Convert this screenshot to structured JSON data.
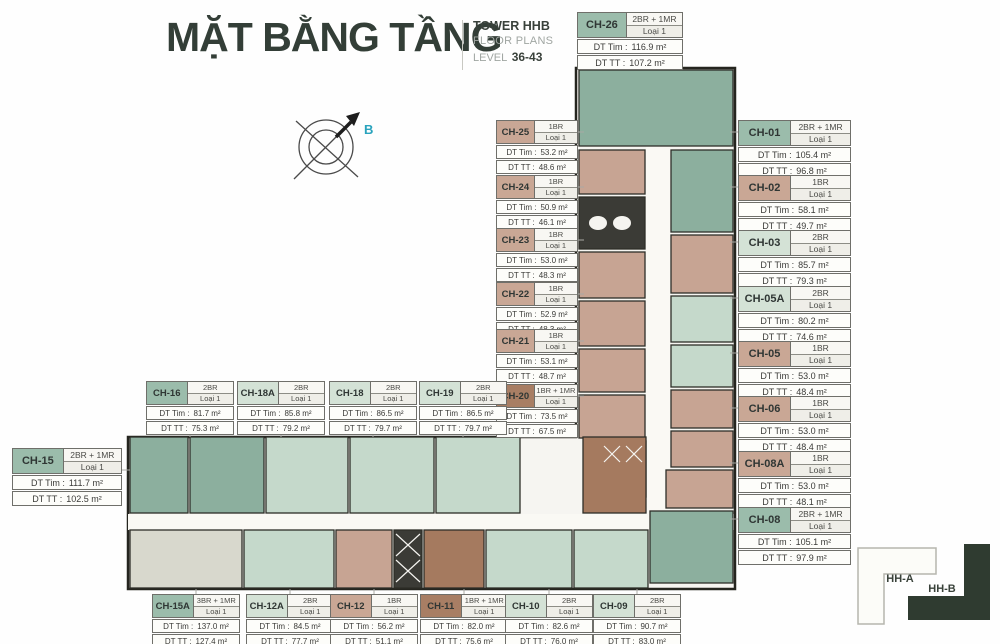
{
  "header": {
    "title": "MẶT BẰNG TẦNG",
    "tower": "TOWER HHB",
    "subtitle": "FLOOR PLANS",
    "level_label": "LEVEL",
    "level_value": "36-43"
  },
  "compass": {
    "label": "B"
  },
  "labels": {
    "dt_tim": "DT Tim :",
    "dt_tt": "DT TT :"
  },
  "colors": {
    "green": "#9bbcab",
    "ltgreen": "#d4e2d6",
    "tan": "#c9a795",
    "brown": "#a87e64"
  },
  "keyplan": {
    "building_a": "HH-A",
    "building_b": "HH-B"
  },
  "units": [
    {
      "id": "CH-26",
      "type": "2BR + 1MR",
      "loai": "Loại 1",
      "dt_tim": "116.9 m²",
      "dt_tt": "107.2 m²",
      "color": "green",
      "x": 577,
      "y": 12,
      "w": 106,
      "size": "md"
    },
    {
      "id": "CH-01",
      "type": "2BR + 1MR",
      "loai": "Loại 1",
      "dt_tim": "105.4 m²",
      "dt_tt": "96.8 m²",
      "color": "green",
      "x": 738,
      "y": 120,
      "w": 113,
      "size": "md"
    },
    {
      "id": "CH-02",
      "type": "1BR",
      "loai": "Loại 1",
      "dt_tim": "58.1 m²",
      "dt_tt": "49.7 m²",
      "color": "tan",
      "x": 738,
      "y": 175,
      "w": 113,
      "size": "md"
    },
    {
      "id": "CH-03",
      "type": "2BR",
      "loai": "Loại 1",
      "dt_tim": "85.7 m²",
      "dt_tt": "79.3 m²",
      "color": "ltgreen",
      "x": 738,
      "y": 230,
      "w": 113,
      "size": "md"
    },
    {
      "id": "CH-05A",
      "type": "2BR",
      "loai": "Loại 1",
      "dt_tim": "80.2 m²",
      "dt_tt": "74.6 m²",
      "color": "ltgreen",
      "x": 738,
      "y": 286,
      "w": 113,
      "size": "md"
    },
    {
      "id": "CH-05",
      "type": "1BR",
      "loai": "Loại 1",
      "dt_tim": "53.0 m²",
      "dt_tt": "48.4 m²",
      "color": "tan",
      "x": 738,
      "y": 341,
      "w": 113,
      "size": "md"
    },
    {
      "id": "CH-06",
      "type": "1BR",
      "loai": "Loại 1",
      "dt_tim": "53.0 m²",
      "dt_tt": "48.4 m²",
      "color": "tan",
      "x": 738,
      "y": 396,
      "w": 113,
      "size": "md"
    },
    {
      "id": "CH-08A",
      "type": "1BR",
      "loai": "Loại 1",
      "dt_tim": "53.0 m²",
      "dt_tt": "48.1 m²",
      "color": "tan",
      "x": 738,
      "y": 451,
      "w": 113,
      "size": "md"
    },
    {
      "id": "CH-08",
      "type": "2BR + 1MR",
      "loai": "Loại 1",
      "dt_tim": "105.1 m²",
      "dt_tt": "97.9 m²",
      "color": "green",
      "x": 738,
      "y": 507,
      "w": 113,
      "size": "md"
    },
    {
      "id": "CH-25",
      "type": "1BR",
      "loai": "Loại 1",
      "dt_tim": "53.2 m²",
      "dt_tt": "48.6 m²",
      "color": "tan",
      "x": 496,
      "y": 120,
      "w": 82,
      "size": "sm"
    },
    {
      "id": "CH-24",
      "type": "1BR",
      "loai": "Loại 1",
      "dt_tim": "50.9 m²",
      "dt_tt": "46.1 m²",
      "color": "tan",
      "x": 496,
      "y": 175,
      "w": 82,
      "size": "sm"
    },
    {
      "id": "CH-23",
      "type": "1BR",
      "loai": "Loại 1",
      "dt_tim": "53.0 m²",
      "dt_tt": "48.3 m²",
      "color": "tan",
      "x": 496,
      "y": 228,
      "w": 82,
      "size": "sm"
    },
    {
      "id": "CH-22",
      "type": "1BR",
      "loai": "Loại 1",
      "dt_tim": "52.9 m²",
      "dt_tt": "48.3 m²",
      "color": "tan",
      "x": 496,
      "y": 282,
      "w": 82,
      "size": "sm"
    },
    {
      "id": "CH-21",
      "type": "1BR",
      "loai": "Loại 1",
      "dt_tim": "53.1 m²",
      "dt_tt": "48.7 m²",
      "color": "tan",
      "x": 496,
      "y": 329,
      "w": 82,
      "size": "sm"
    },
    {
      "id": "CH-20",
      "type": "1BR + 1MR",
      "loai": "Loại 1",
      "dt_tim": "73.5 m²",
      "dt_tt": "67.5 m²",
      "color": "brown",
      "x": 496,
      "y": 384,
      "w": 82,
      "size": "sm"
    },
    {
      "id": "CH-16",
      "type": "2BR",
      "loai": "Loại 1",
      "dt_tim": "81.7 m²",
      "dt_tt": "75.3 m²",
      "color": "green",
      "x": 146,
      "y": 381,
      "w": 88,
      "size": "sm"
    },
    {
      "id": "CH-18A",
      "type": "2BR",
      "loai": "Loại 1",
      "dt_tim": "85.8 m²",
      "dt_tt": "79.2 m²",
      "color": "ltgreen",
      "x": 237,
      "y": 381,
      "w": 88,
      "size": "sm"
    },
    {
      "id": "CH-18",
      "type": "2BR",
      "loai": "Loại 1",
      "dt_tim": "86.5 m²",
      "dt_tt": "79.7 m²",
      "color": "ltgreen",
      "x": 329,
      "y": 381,
      "w": 88,
      "size": "sm"
    },
    {
      "id": "CH-19",
      "type": "2BR",
      "loai": "Loại 1",
      "dt_tim": "86.5 m²",
      "dt_tt": "79.7 m²",
      "color": "ltgreen",
      "x": 419,
      "y": 381,
      "w": 88,
      "size": "sm"
    },
    {
      "id": "CH-15",
      "type": "2BR + 1MR",
      "loai": "Loại 1",
      "dt_tim": "111.7 m²",
      "dt_tt": "102.5 m²",
      "color": "green",
      "x": 12,
      "y": 448,
      "w": 110,
      "size": "md"
    },
    {
      "id": "CH-15A",
      "type": "3BR + 1MR",
      "loai": "Loại 1",
      "dt_tim": "137.0 m²",
      "dt_tt": "127.4 m²",
      "color": "green",
      "x": 152,
      "y": 594,
      "w": 88,
      "size": "sm"
    },
    {
      "id": "CH-12A",
      "type": "2BR",
      "loai": "Loại 1",
      "dt_tim": "84.5 m²",
      "dt_tt": "77.7 m²",
      "color": "ltgreen",
      "x": 246,
      "y": 594,
      "w": 88,
      "size": "sm"
    },
    {
      "id": "CH-12",
      "type": "1BR",
      "loai": "Loại 1",
      "dt_tim": "56.2 m²",
      "dt_tt": "51.1 m²",
      "color": "tan",
      "x": 330,
      "y": 594,
      "w": 88,
      "size": "sm"
    },
    {
      "id": "CH-11",
      "type": "1BR + 1MR",
      "loai": "Loại 1",
      "dt_tim": "82.0 m²",
      "dt_tt": "75.6 m²",
      "color": "brown",
      "x": 420,
      "y": 594,
      "w": 88,
      "size": "sm"
    },
    {
      "id": "CH-10",
      "type": "2BR",
      "loai": "Loại 1",
      "dt_tim": "82.6 m²",
      "dt_tt": "76.0 m²",
      "color": "ltgreen",
      "x": 505,
      "y": 594,
      "w": 88,
      "size": "sm"
    },
    {
      "id": "CH-09",
      "type": "2BR",
      "loai": "Loại 1",
      "dt_tim": "90.7 m²",
      "dt_tt": "83.0 m²",
      "color": "ltgreen",
      "x": 593,
      "y": 594,
      "w": 88,
      "size": "sm"
    }
  ]
}
